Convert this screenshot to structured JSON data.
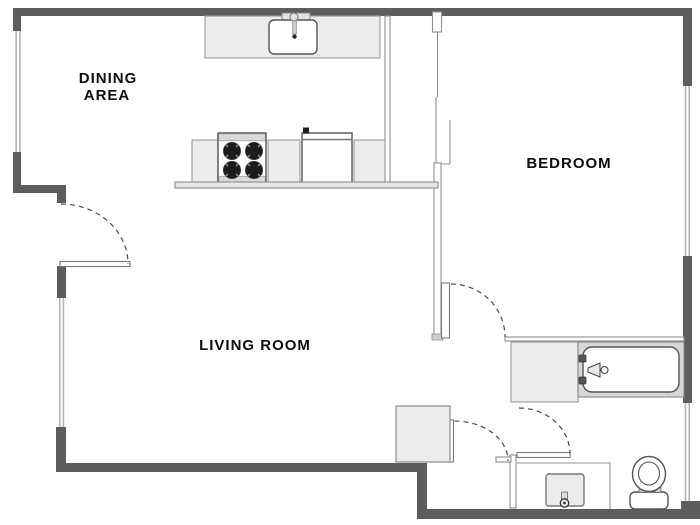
{
  "title": "apartment-floor-plan",
  "rooms": {
    "dining": {
      "line1": "DINING",
      "line2": "AREA"
    },
    "living": {
      "label": "LIVING ROOM"
    },
    "bedroom": {
      "label": "BEDROOM"
    }
  },
  "fixtures": {
    "kitchen_sink": "kitchen-sink",
    "stove": "stove-4-burners",
    "dishwasher": "dishwasher",
    "breakfast_bar": "breakfast-bar",
    "bathtub": "bathtub",
    "vanity": "bathroom-vanity",
    "bathroom_sink": "bathroom-sink",
    "toilet": "toilet",
    "closet": "closet"
  },
  "colors": {
    "wall_thick": "#5d5d5d",
    "wall_thin": "#909090",
    "window_line": "#b5b5b5",
    "counter_fill": "#ececec",
    "tub_surround": "#d7d7d7",
    "fixture_stroke": "#555555",
    "burner_fill": "#1c1c1c",
    "door_arc": "#4a4a4a",
    "label_color": "#0d0d0d"
  }
}
